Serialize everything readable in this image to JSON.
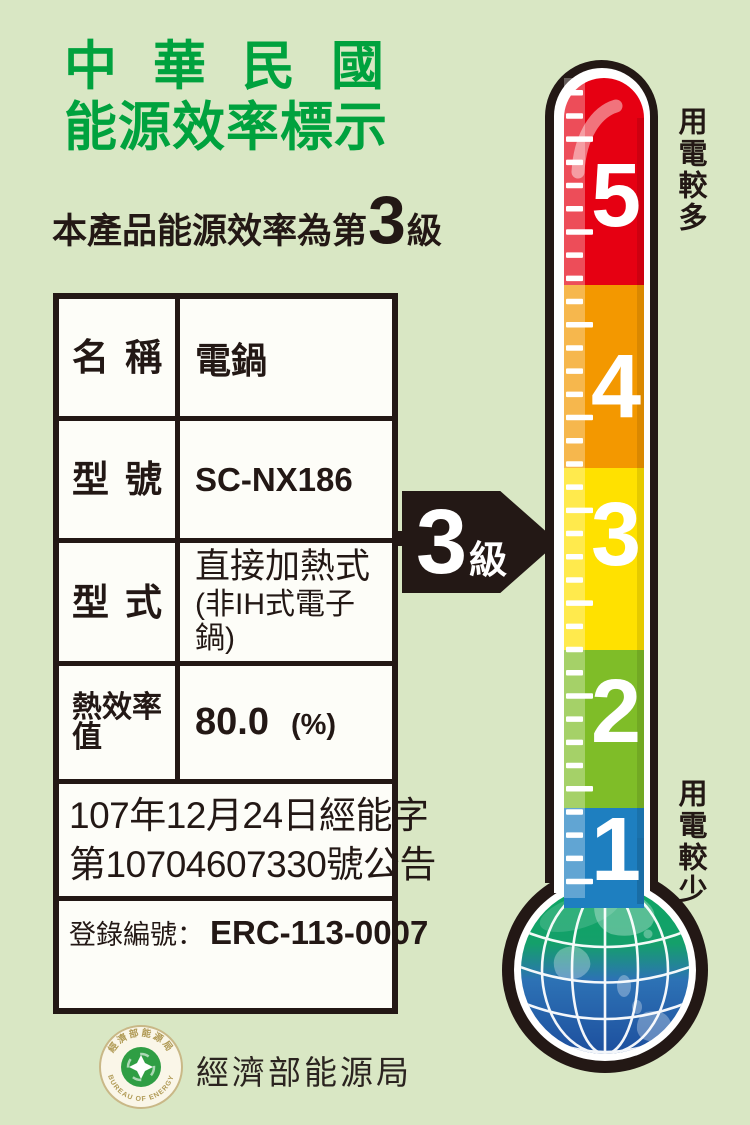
{
  "header": {
    "title_line1": "中華民國",
    "title_line2": "能源效率標示",
    "subtitle_prefix": "本產品能源效率為第",
    "subtitle_grade": "3",
    "subtitle_suffix": "級"
  },
  "table": {
    "rows": [
      {
        "label": "名稱",
        "value": "電鍋"
      },
      {
        "label": "型號",
        "value": "SC-NX186"
      },
      {
        "label": "型式",
        "value_line1": "直接加熱式",
        "value_line2": "(非IH式電子鍋)"
      },
      {
        "label": "熱效率值",
        "value": "80.0",
        "unit": "(%)"
      }
    ],
    "announcement_line1": "107年12月24日經能字",
    "announcement_line2": "第10704607330號公告",
    "registration_label": "登錄編號：",
    "registration_value": "ERC-113-0007"
  },
  "grade_arrow": {
    "number": "3",
    "suffix": "級"
  },
  "thermometer": {
    "top_caption": "用電較多",
    "bottom_caption": "用電較少",
    "levels": [
      {
        "value": "5",
        "color": "#e60012"
      },
      {
        "value": "4",
        "color": "#f39800"
      },
      {
        "value": "3",
        "color": "#ffe100"
      },
      {
        "value": "2",
        "color": "#7fbd28"
      },
      {
        "value": "1",
        "color": "#1e7fc0"
      }
    ]
  },
  "footer": {
    "agency": "經濟部能源局",
    "seal_top_text": "經濟部能源局",
    "seal_bottom_text": "BUREAU OF ENERGY"
  },
  "colors": {
    "background": "#d9e7c4",
    "title_green": "#00a23e",
    "ink": "#231815"
  }
}
